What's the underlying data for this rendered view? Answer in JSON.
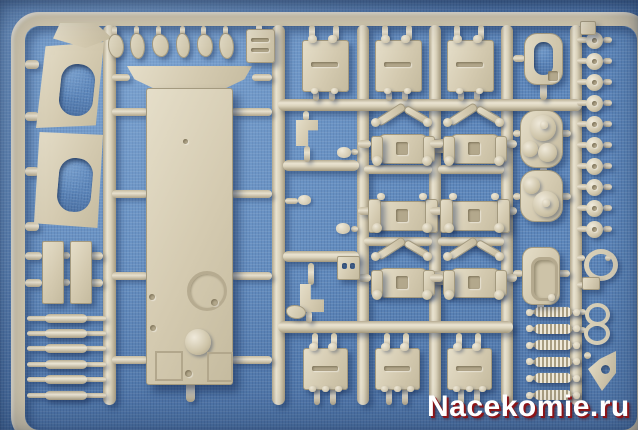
{
  "image": {
    "type": "photograph",
    "subject": "tan plastic model-kit sprue (injection molded parts tree) lying on blue woven fabric"
  },
  "watermark": {
    "text": "Nacekomie.ru",
    "text_color": "#ffffff",
    "shadow_color": "#8c1418"
  },
  "colors": {
    "background": "#5d87bb",
    "sprue": "#d2c8af",
    "sprue_highlight": "#eae4d2",
    "sprue_shadow": "#a2977c",
    "cast_shadow": "rgba(20,40,80,0.45)"
  },
  "parts_inventory": [
    {
      "part": "hull tub with flange",
      "count": 1
    },
    {
      "part": "suspension bogies",
      "count": 6
    },
    {
      "part": "square hatch plates",
      "count": 6
    },
    {
      "part": "side plates with oval openings",
      "count": 2
    },
    {
      "part": "road wheels / rollers",
      "count": 10
    },
    {
      "part": "turret dome parts",
      "count": 2
    },
    {
      "part": "oval hatches",
      "count": 2
    },
    {
      "part": "coil springs",
      "count": 6
    },
    {
      "part": "axle rods",
      "count": 6
    },
    {
      "part": "small detail parts",
      "count": 20
    }
  ],
  "sprue": {
    "rails": [
      [
        103,
        25,
        13,
        380,
        "v"
      ],
      [
        272,
        25,
        13,
        380,
        "v"
      ],
      [
        357,
        25,
        12,
        380,
        "v"
      ],
      [
        429,
        25,
        12,
        380,
        "v"
      ],
      [
        501,
        25,
        12,
        380,
        "v"
      ],
      [
        570,
        25,
        12,
        380,
        "v"
      ],
      [
        278,
        99,
        304,
        12,
        "h"
      ],
      [
        278,
        321,
        235,
        12,
        "h"
      ],
      [
        283,
        160,
        76,
        11,
        "h"
      ],
      [
        283,
        251,
        76,
        11,
        "h"
      ],
      [
        364,
        165,
        68,
        9,
        "h"
      ],
      [
        438,
        165,
        66,
        9,
        "h"
      ],
      [
        364,
        237,
        68,
        9,
        "h"
      ],
      [
        438,
        237,
        66,
        9,
        "h"
      ]
    ],
    "sleeves": [
      [
        424,
        139,
        34,
        14
      ],
      [
        436,
        204,
        36,
        14
      ],
      [
        424,
        271,
        34,
        14
      ]
    ],
    "stubs": [
      [
        112,
        108,
        36,
        8
      ],
      [
        112,
        190,
        36,
        8
      ],
      [
        112,
        272,
        36,
        8
      ],
      [
        112,
        356,
        36,
        8
      ],
      [
        231,
        108,
        41,
        8
      ],
      [
        231,
        190,
        41,
        8
      ],
      [
        231,
        272,
        41,
        8
      ],
      [
        231,
        356,
        41,
        8
      ],
      [
        112,
        74,
        18,
        7
      ],
      [
        252,
        74,
        20,
        7
      ],
      [
        186,
        382,
        9,
        20
      ],
      [
        25,
        60,
        14,
        9
      ],
      [
        25,
        112,
        14,
        9
      ],
      [
        25,
        167,
        14,
        9
      ],
      [
        25,
        222,
        14,
        9
      ],
      [
        25,
        252,
        17,
        8
      ],
      [
        25,
        279,
        17,
        8
      ],
      [
        62,
        252,
        8,
        7
      ],
      [
        62,
        279,
        8,
        7
      ],
      [
        90,
        252,
        13,
        8
      ],
      [
        90,
        279,
        13,
        8
      ],
      [
        303,
        111,
        6,
        10
      ],
      [
        304,
        146,
        6,
        16
      ],
      [
        351,
        149,
        7,
        6
      ],
      [
        285,
        198,
        13,
        6
      ],
      [
        351,
        226,
        7,
        6
      ],
      [
        308,
        263,
        6,
        22
      ],
      [
        306,
        311,
        6,
        12
      ],
      [
        540,
        82,
        7,
        18
      ],
      [
        513,
        55,
        12,
        7
      ],
      [
        513,
        130,
        8,
        7
      ],
      [
        559,
        130,
        12,
        7
      ],
      [
        513,
        193,
        8,
        7
      ],
      [
        559,
        193,
        12,
        7
      ],
      [
        540,
        166,
        7,
        8
      ],
      [
        513,
        270,
        10,
        7
      ],
      [
        557,
        270,
        13,
        7
      ],
      [
        537,
        302,
        7,
        8
      ],
      [
        577,
        255,
        8,
        6
      ],
      [
        605,
        255,
        6,
        6
      ],
      [
        577,
        282,
        7,
        6
      ],
      [
        577,
        309,
        9,
        6
      ],
      [
        577,
        327,
        9,
        6
      ],
      [
        584,
        352,
        7,
        7
      ],
      [
        112,
        26,
        5,
        10
      ],
      [
        134,
        26,
        5,
        9
      ],
      [
        156,
        26,
        5,
        10
      ],
      [
        180,
        26,
        5,
        9
      ],
      [
        201,
        26,
        5,
        10
      ],
      [
        223,
        26,
        5,
        9
      ],
      [
        256,
        24,
        6,
        8
      ]
    ],
    "discs": {
      "x": 586,
      "y0": 40,
      "step": 21,
      "count": 10,
      "d": 17
    },
    "rungs": {
      "x": 27,
      "w": 79,
      "y0": 318,
      "step": 15.4,
      "count": 6
    },
    "springs": {
      "x": 527,
      "w": 53,
      "y0": 312,
      "step": 16.6,
      "count": 6
    },
    "plates_top": [
      [
        302,
        40,
        45,
        50
      ],
      [
        375,
        40,
        45,
        50
      ],
      [
        447,
        40,
        45,
        50
      ]
    ],
    "plates_bottom": [
      [
        303,
        348,
        43,
        40
      ],
      [
        375,
        348,
        43,
        40
      ],
      [
        447,
        348,
        43,
        40
      ]
    ],
    "bogies": [
      {
        "x": 371,
        "y": 122,
        "v": "diag"
      },
      {
        "x": 443,
        "y": 122,
        "v": "diag"
      },
      {
        "x": 371,
        "y": 189,
        "v": "mid"
      },
      {
        "x": 443,
        "y": 189,
        "v": "mid"
      },
      {
        "x": 371,
        "y": 256,
        "v": "diag"
      },
      {
        "x": 443,
        "y": 256,
        "v": "diag"
      }
    ],
    "hull": {
      "x": 146,
      "y": 88,
      "w": 85,
      "h": 295,
      "flange": {
        "x": 127,
        "y": 66,
        "w": 125,
        "h": 24
      }
    },
    "left_plates": [
      {
        "x": 36,
        "y": 42,
        "w": 68,
        "h": 86,
        "poly": "polygon(14% 5%,100% 0%,88% 97%,0% 100%)",
        "hole": [
          24,
          22,
          34,
          52
        ],
        "rot": 6
      },
      {
        "x": 34,
        "y": 132,
        "w": 69,
        "h": 96,
        "poly": "polygon(8% 0%,100% 3%,92% 100%,0% 95%)",
        "hole": [
          24,
          26,
          34,
          54
        ],
        "rot": 5
      }
    ],
    "diamond": {
      "x": 53,
      "y": 23,
      "w": 59,
      "h": 25
    },
    "strips": [
      [
        42,
        241,
        20,
        61
      ],
      [
        70,
        241,
        20,
        61
      ]
    ],
    "smalls": [
      {
        "x": 108,
        "y": 34,
        "w": 14,
        "h": 22,
        "s": "blob"
      },
      {
        "x": 130,
        "y": 33,
        "w": 13,
        "h": 24,
        "s": "blob"
      },
      {
        "x": 152,
        "y": 34,
        "w": 15,
        "h": 21,
        "s": "blob"
      },
      {
        "x": 176,
        "y": 33,
        "w": 12,
        "h": 23,
        "s": "blob"
      },
      {
        "x": 197,
        "y": 34,
        "w": 14,
        "h": 21,
        "s": "blob"
      },
      {
        "x": 219,
        "y": 33,
        "w": 13,
        "h": 24,
        "s": "blob"
      },
      {
        "x": 246,
        "y": 29,
        "w": 27,
        "h": 32,
        "s": "box"
      },
      {
        "x": 580,
        "y": 21,
        "w": 14,
        "h": 12,
        "s": "rect"
      },
      {
        "x": 524,
        "y": 33,
        "w": 37,
        "h": 50,
        "s": "hatch"
      },
      {
        "x": 520,
        "y": 110,
        "w": 41,
        "h": 56,
        "s": "turret1"
      },
      {
        "x": 520,
        "y": 170,
        "w": 41,
        "h": 50,
        "s": "turret2"
      },
      {
        "x": 522,
        "y": 247,
        "w": 36,
        "h": 56,
        "s": "hatch2"
      },
      {
        "x": 584,
        "y": 249,
        "w": 24,
        "h": 22,
        "s": "ring",
        "b": 5
      },
      {
        "x": 582,
        "y": 277,
        "w": 16,
        "h": 11,
        "s": "rect"
      },
      {
        "x": 585,
        "y": 303,
        "w": 17,
        "h": 15,
        "s": "ring",
        "b": 4
      },
      {
        "x": 584,
        "y": 322,
        "w": 18,
        "h": 15,
        "s": "ring",
        "b": 4
      },
      {
        "x": 588,
        "y": 351,
        "w": 28,
        "h": 40,
        "s": "tri"
      },
      {
        "x": 296,
        "y": 120,
        "w": 22,
        "h": 26,
        "s": "bracketL1"
      },
      {
        "x": 337,
        "y": 147,
        "w": 14,
        "h": 11,
        "s": "knob"
      },
      {
        "x": 298,
        "y": 195,
        "w": 13,
        "h": 10,
        "s": "knob"
      },
      {
        "x": 336,
        "y": 223,
        "w": 14,
        "h": 11,
        "s": "knob"
      },
      {
        "x": 337,
        "y": 256,
        "w": 21,
        "h": 22,
        "s": "sq2"
      },
      {
        "x": 300,
        "y": 284,
        "w": 24,
        "h": 28,
        "s": "bracketL2"
      },
      {
        "x": 286,
        "y": 305,
        "w": 18,
        "h": 12,
        "s": "blob"
      }
    ]
  }
}
